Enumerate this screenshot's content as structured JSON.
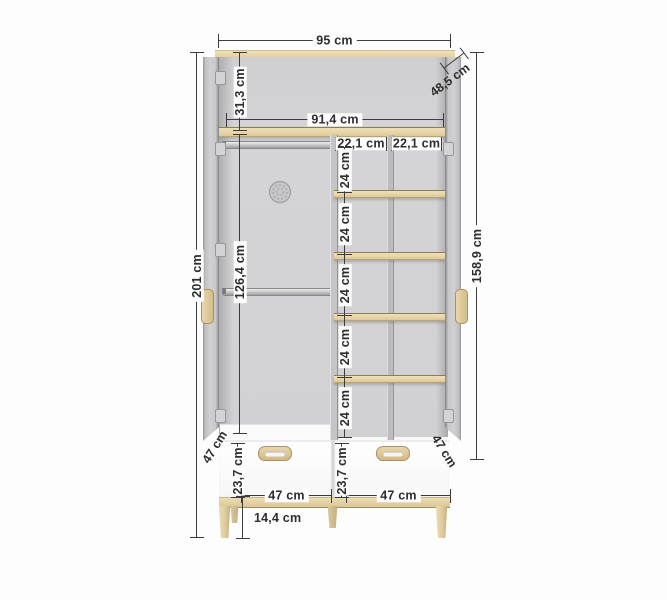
{
  "dimensions": {
    "overall_width": "95 cm",
    "overall_height": "201 cm",
    "depth": "48,5 cm",
    "inner_width": "91,4 cm",
    "top_section_height": "31,3 cm",
    "hanging_section_height": "126,4 cm",
    "side_inner_height": "158,9 cm",
    "leg_height": "14,4 cm",
    "cubby_widths": [
      "22,1 cm",
      "22,1 cm"
    ],
    "cubby_heights": [
      "24 cm",
      "24 cm",
      "24 cm",
      "24 cm",
      "24 cm"
    ],
    "door_widths": [
      "47 cm",
      "47 cm"
    ],
    "drawer_front_heights": [
      "23,7 cm",
      "23,7 cm"
    ],
    "drawer_widths": [
      "47 cm",
      "47 cm"
    ]
  },
  "colors": {
    "wood": "#e8d5a8",
    "carcass": "#d2d2d4",
    "drawer_front": "#fcfcfc",
    "dimension_line": "#3c3c3c",
    "background": "#fdfdfd"
  }
}
